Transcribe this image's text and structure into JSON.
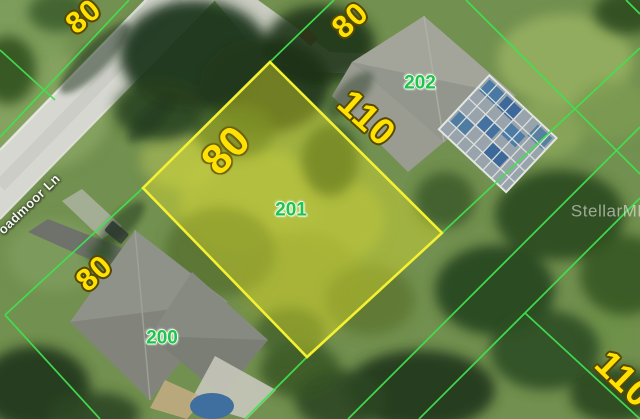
{
  "map": {
    "street": {
      "name_visible": "oadmoor Ln"
    },
    "watermark": {
      "text": "StellarMLS"
    },
    "parcels": {
      "p200": {
        "number": "200"
      },
      "p201": {
        "number": "201"
      },
      "p202": {
        "number": "202"
      }
    },
    "dimensions": {
      "far_north_frontage": "80",
      "north_frontage": "80",
      "parcel_201_depth": "110",
      "parcel_201_frontage": "80",
      "south_frontage": "80",
      "southeast_depth": "110"
    },
    "colors": {
      "highlight_border": "#f4f032",
      "highlight_fill": "rgba(236,235,43,0.38)",
      "boundary_line": "#43e050",
      "dimension_text": "#ffe103",
      "dimension_outline": "#564a00",
      "parcel_number_text": "#25c14f",
      "street_text": "#f3f5f0",
      "watermark_text": "rgba(255,255,255,0.52)"
    }
  }
}
